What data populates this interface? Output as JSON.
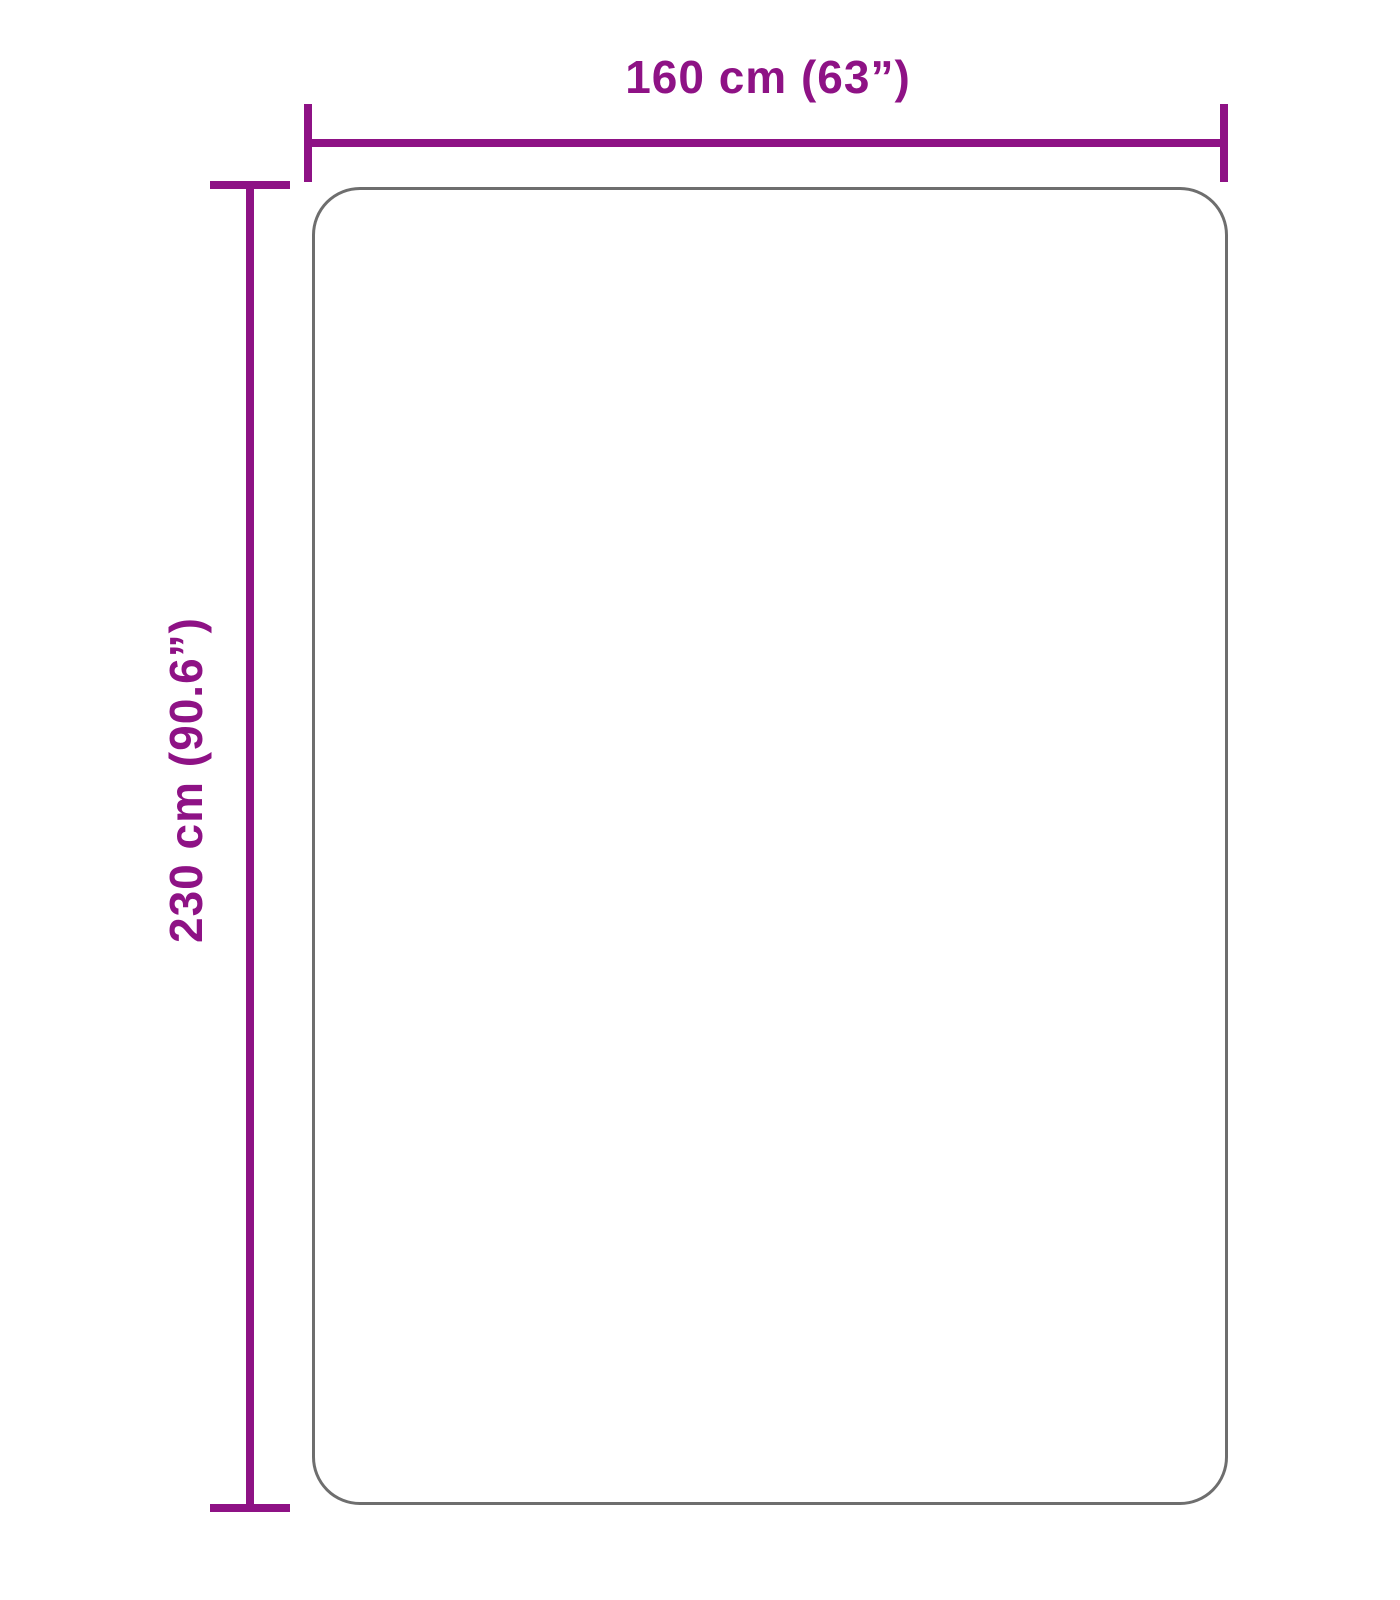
{
  "diagram": {
    "type": "product-dimension-diagram",
    "shape": "rounded-rectangle",
    "width_label": "160 cm (63”)",
    "height_label": "230 cm (90.6”)",
    "width_cm": 160,
    "width_inches": 63,
    "height_cm": 230,
    "height_inches": 90.6
  },
  "colors": {
    "dimension": "#8e1285",
    "outline": "#6e6e6e",
    "background": "#ffffff"
  }
}
